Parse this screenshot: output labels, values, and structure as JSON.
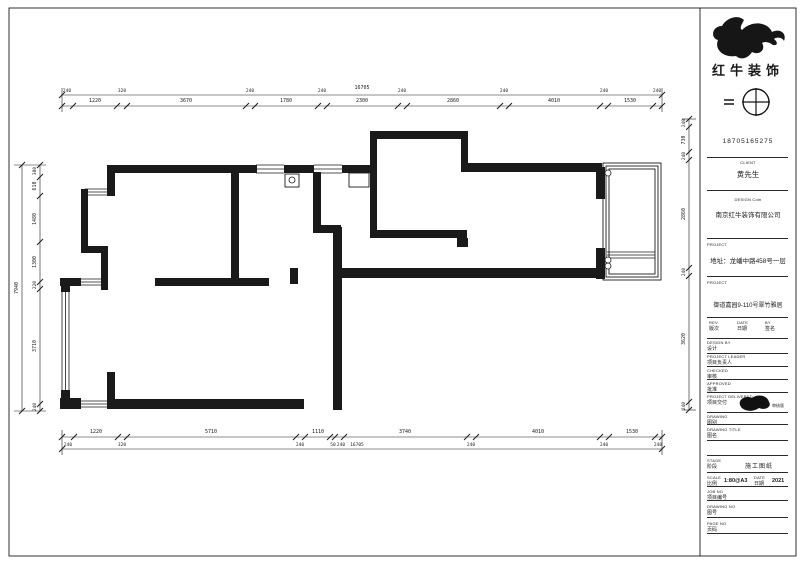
{
  "meta": {
    "ink": "#1a1a1a",
    "bg": "#ffffff"
  },
  "logo": {
    "brand": "红牛装饰"
  },
  "title_block": {
    "phone": "18705165275",
    "client_label": "CLIENT",
    "client": "黄先生",
    "company_label": "DESIGN Com",
    "company": "南京红牛装饰有限公司",
    "project_label": "PROJECT",
    "address": "地址：龙蟠中路458号一层",
    "project_label2": "PROJECT",
    "project_name": "御道嘉园9-110号翠竹雅居",
    "rev_cols": [
      {
        "en": "REV.",
        "cn": "版次"
      },
      {
        "en": "DATE",
        "cn": "日期"
      },
      {
        "en": "BY",
        "cn": "签名"
      }
    ],
    "rows": [
      {
        "en": "DESIGN BY",
        "cn": "设计"
      },
      {
        "en": "PROJECT LEADER",
        "cn": "项目负责人"
      },
      {
        "en": "CHECKED",
        "cn": "审核"
      },
      {
        "en": "APPROVED",
        "cn": "批准"
      }
    ],
    "delivered": {
      "en": "PROJECT DELIVERED",
      "cn": "项目交付",
      "stamp": "审核版"
    },
    "drawing_label": {
      "en": "DRAWING",
      "cn": "图别"
    },
    "drawing_title_label": {
      "en": "DRAWING TITLE",
      "cn": "图名"
    },
    "stage": {
      "en": "STAGE",
      "cn": "阶段",
      "value": "施工图纸"
    },
    "scale": {
      "en": "SCALE",
      "cn": "比例",
      "value": "1:80@A3"
    },
    "date": {
      "en": "DATE",
      "cn": "日期",
      "value": "2021"
    },
    "job_no": {
      "en": "JOB NO",
      "cn": "项目编号"
    },
    "drawing_no": {
      "en": "DRAWING NO",
      "cn": "图号"
    },
    "page_no": {
      "en": "PAGE NO",
      "cn": "页码"
    }
  },
  "dimensions": {
    "top": {
      "lines": [
        [
          62,
          95,
          662,
          95
        ],
        [
          62,
          106,
          662,
          106
        ],
        [
          62,
          88,
          62,
          112
        ],
        [
          662,
          88,
          662,
          112
        ]
      ],
      "ticks": [
        [
          62,
          106
        ],
        [
          73,
          106
        ],
        [
          117,
          106
        ],
        [
          127,
          106
        ],
        [
          246,
          106
        ],
        [
          255,
          106
        ],
        [
          318,
          106
        ],
        [
          327,
          106
        ],
        [
          398,
          106
        ],
        [
          407,
          106
        ],
        [
          500,
          106
        ],
        [
          509,
          106
        ],
        [
          600,
          106
        ],
        [
          608,
          106
        ],
        [
          653,
          106
        ],
        [
          662,
          106
        ],
        [
          62,
          95
        ],
        [
          662,
          95
        ]
      ],
      "labels": [
        {
          "t": "1220",
          "x": 95,
          "y": 102
        },
        {
          "t": "3670",
          "x": 186,
          "y": 102
        },
        {
          "t": "1780",
          "x": 286,
          "y": 102
        },
        {
          "t": "2300",
          "x": 362,
          "y": 102
        },
        {
          "t": "2860",
          "x": 453,
          "y": 102
        },
        {
          "t": "4010",
          "x": 554,
          "y": 102
        },
        {
          "t": "1530",
          "x": 630,
          "y": 102
        },
        {
          "t": "240",
          "x": 67,
          "y": 92,
          "s": 4.5
        },
        {
          "t": "320",
          "x": 122,
          "y": 92,
          "s": 4.5
        },
        {
          "t": "240",
          "x": 250,
          "y": 92,
          "s": 4.5
        },
        {
          "t": "240",
          "x": 322,
          "y": 92,
          "s": 4.5
        },
        {
          "t": "240",
          "x": 402,
          "y": 92,
          "s": 4.5
        },
        {
          "t": "240",
          "x": 504,
          "y": 92,
          "s": 4.5
        },
        {
          "t": "240",
          "x": 604,
          "y": 92,
          "s": 4.5
        },
        {
          "t": "240",
          "x": 657,
          "y": 92,
          "s": 4.5
        },
        {
          "t": "16705",
          "x": 362,
          "y": 89,
          "s": 5
        }
      ]
    },
    "bottom": {
      "lines": [
        [
          62,
          437,
          662,
          437
        ],
        [
          62,
          449,
          662,
          449
        ],
        [
          62,
          430,
          62,
          455
        ],
        [
          662,
          430,
          662,
          455
        ]
      ],
      "ticks": [
        [
          62,
          437
        ],
        [
          74,
          437
        ],
        [
          118,
          437
        ],
        [
          127,
          437
        ],
        [
          296,
          437
        ],
        [
          305,
          437
        ],
        [
          330,
          437
        ],
        [
          335,
          437
        ],
        [
          344,
          437
        ],
        [
          467,
          437
        ],
        [
          476,
          437
        ],
        [
          600,
          437
        ],
        [
          609,
          437
        ],
        [
          655,
          437
        ],
        [
          662,
          437
        ],
        [
          62,
          449
        ],
        [
          662,
          449
        ]
      ],
      "labels": [
        {
          "t": "1220",
          "x": 96,
          "y": 433
        },
        {
          "t": "5710",
          "x": 211,
          "y": 433
        },
        {
          "t": "1110",
          "x": 318,
          "y": 433
        },
        {
          "t": "3740",
          "x": 405,
          "y": 433
        },
        {
          "t": "4010",
          "x": 538,
          "y": 433
        },
        {
          "t": "1530",
          "x": 632,
          "y": 433
        },
        {
          "t": "240",
          "x": 68,
          "y": 446,
          "s": 4.5
        },
        {
          "t": "320",
          "x": 122,
          "y": 446,
          "s": 4.5
        },
        {
          "t": "240",
          "x": 300,
          "y": 446,
          "s": 4.5
        },
        {
          "t": "50",
          "x": 333,
          "y": 446,
          "s": 4.5
        },
        {
          "t": "240",
          "x": 341,
          "y": 446,
          "s": 4.5
        },
        {
          "t": "240",
          "x": 471,
          "y": 446,
          "s": 4.5
        },
        {
          "t": "240",
          "x": 604,
          "y": 446,
          "s": 4.5
        },
        {
          "t": "240",
          "x": 658,
          "y": 446,
          "s": 4.5
        },
        {
          "t": "16705",
          "x": 357,
          "y": 446,
          "s": 4.5
        }
      ]
    },
    "left": {
      "lines": [
        [
          40,
          165,
          40,
          411
        ],
        [
          22,
          165,
          22,
          411
        ],
        [
          14,
          165,
          46,
          165
        ],
        [
          14,
          411,
          46,
          411
        ]
      ],
      "ticks": [
        [
          40,
          165
        ],
        [
          40,
          177
        ],
        [
          40,
          196
        ],
        [
          40,
          242
        ],
        [
          40,
          282
        ],
        [
          40,
          289
        ],
        [
          40,
          404
        ],
        [
          40,
          411
        ],
        [
          22,
          165
        ],
        [
          22,
          411
        ]
      ],
      "labels": [
        {
          "t": "380",
          "x": 36,
          "y": 171,
          "v": true,
          "s": 4.5
        },
        {
          "t": "610",
          "x": 36,
          "y": 186,
          "v": true
        },
        {
          "t": "1480",
          "x": 36,
          "y": 219,
          "v": true
        },
        {
          "t": "1300",
          "x": 36,
          "y": 262,
          "v": true
        },
        {
          "t": "220",
          "x": 36,
          "y": 285,
          "v": true,
          "s": 4.5
        },
        {
          "t": "3710",
          "x": 36,
          "y": 346,
          "v": true
        },
        {
          "t": "240",
          "x": 36,
          "y": 407,
          "v": true,
          "s": 4.5
        },
        {
          "t": "7940",
          "x": 18,
          "y": 288,
          "v": true,
          "s": 5
        }
      ]
    },
    "right": {
      "lines": [
        [
          689,
          119,
          689,
          410
        ],
        [
          682,
          119,
          696,
          119
        ],
        [
          682,
          410,
          696,
          410
        ]
      ],
      "ticks": [
        [
          689,
          119
        ],
        [
          689,
          127
        ],
        [
          689,
          152
        ],
        [
          689,
          160
        ],
        [
          689,
          268
        ],
        [
          689,
          276
        ],
        [
          689,
          402
        ],
        [
          689,
          410
        ]
      ],
      "labels": [
        {
          "t": "240",
          "x": 685,
          "y": 123,
          "v": true,
          "s": 4.5
        },
        {
          "t": "730",
          "x": 685,
          "y": 140,
          "v": true
        },
        {
          "t": "240",
          "x": 685,
          "y": 156,
          "v": true,
          "s": 4.5
        },
        {
          "t": "2860",
          "x": 685,
          "y": 214,
          "v": true
        },
        {
          "t": "240",
          "x": 685,
          "y": 272,
          "v": true,
          "s": 4.5
        },
        {
          "t": "3620",
          "x": 685,
          "y": 339,
          "v": true
        },
        {
          "t": "240",
          "x": 685,
          "y": 406,
          "v": true,
          "s": 4.5
        }
      ]
    }
  },
  "floor_plan": {
    "walls": [
      [
        113,
        165,
        144,
        8
      ],
      [
        284,
        165,
        30,
        8
      ],
      [
        342,
        165,
        30,
        8
      ],
      [
        370,
        131,
        98,
        8
      ],
      [
        370,
        139,
        7,
        26
      ],
      [
        461,
        139,
        7,
        26
      ],
      [
        461,
        163,
        141,
        9
      ],
      [
        596,
        167,
        9,
        32
      ],
      [
        596,
        248,
        9,
        31
      ],
      [
        341,
        268,
        262,
        10
      ],
      [
        333,
        227,
        9,
        183
      ],
      [
        313,
        225,
        28,
        8
      ],
      [
        313,
        172,
        8,
        56
      ],
      [
        370,
        163,
        7,
        70
      ],
      [
        370,
        230,
        97,
        8
      ],
      [
        457,
        238,
        11,
        9
      ],
      [
        231,
        172,
        8,
        112
      ],
      [
        155,
        278,
        114,
        8
      ],
      [
        290,
        268,
        8,
        16
      ],
      [
        107,
        165,
        8,
        31
      ],
      [
        81,
        189,
        7,
        64
      ],
      [
        81,
        246,
        27,
        7
      ],
      [
        101,
        246,
        7,
        44
      ],
      [
        60,
        278,
        21,
        8
      ],
      [
        61,
        284,
        9,
        8
      ],
      [
        61,
        390,
        9,
        11
      ],
      [
        60,
        398,
        21,
        11
      ],
      [
        107,
        372,
        8,
        37
      ],
      [
        107,
        399,
        197,
        10
      ]
    ],
    "outlines": [
      [
        9,
        8,
        787,
        548
      ],
      [
        603,
        163,
        58,
        117
      ],
      [
        606,
        166,
        52,
        111
      ],
      [
        609,
        169,
        46,
        105
      ],
      [
        285,
        174,
        14,
        13
      ],
      [
        349,
        173,
        20,
        14
      ]
    ],
    "windows": [
      [
        256,
        165,
        28,
        8
      ],
      [
        314,
        165,
        28,
        8
      ],
      [
        85,
        189,
        23,
        6
      ],
      [
        80,
        279,
        28,
        6
      ],
      [
        62,
        290,
        7,
        102
      ],
      [
        80,
        401,
        28,
        6
      ],
      [
        607,
        252,
        48,
        6
      ]
    ],
    "circles": [
      [
        292,
        180,
        3
      ],
      [
        608,
        173,
        3
      ],
      [
        608,
        260,
        3
      ],
      [
        608,
        266,
        3
      ]
    ],
    "lines": [
      [
        700,
        8,
        700,
        556
      ]
    ]
  }
}
